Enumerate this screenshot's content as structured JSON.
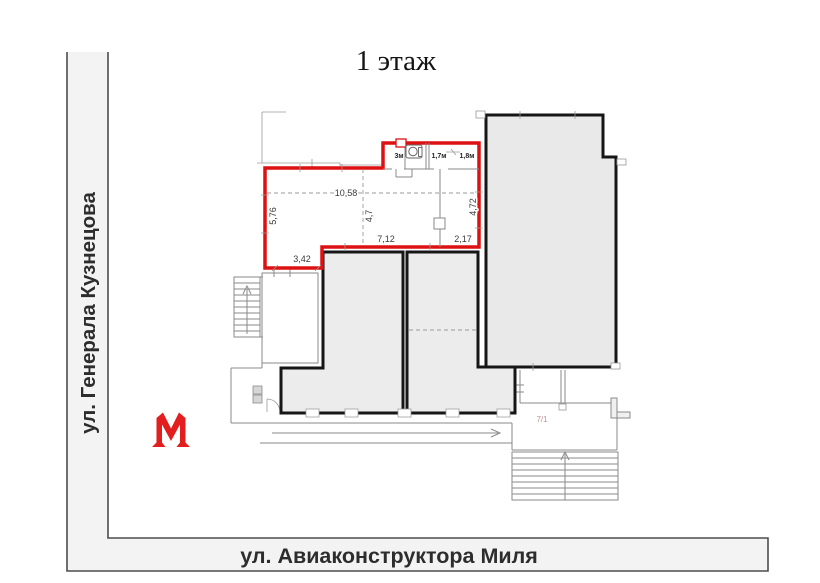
{
  "title": "1 этаж",
  "streets": {
    "vertical": {
      "name": "ул. Генерала Кузнецова"
    },
    "horizontal": {
      "name": "ул. Авиаконструктора Миля"
    }
  },
  "metro": {
    "letter_icon": "М",
    "color": "#e21e1e"
  },
  "plan": {
    "outline_color": "#dd1111",
    "building_number": "7/1",
    "dimensions": {
      "left_wall": "5,76",
      "top_width": "10,58",
      "inner_height": "4,7",
      "bottom_left_step": "3,42",
      "bottom_mid": "7,12",
      "bottom_right": "2,17",
      "right_wall": "4,72"
    },
    "small_rooms": [
      {
        "label": "3м"
      },
      {
        "label": "1,7м"
      },
      {
        "label": "1,8м"
      }
    ]
  }
}
